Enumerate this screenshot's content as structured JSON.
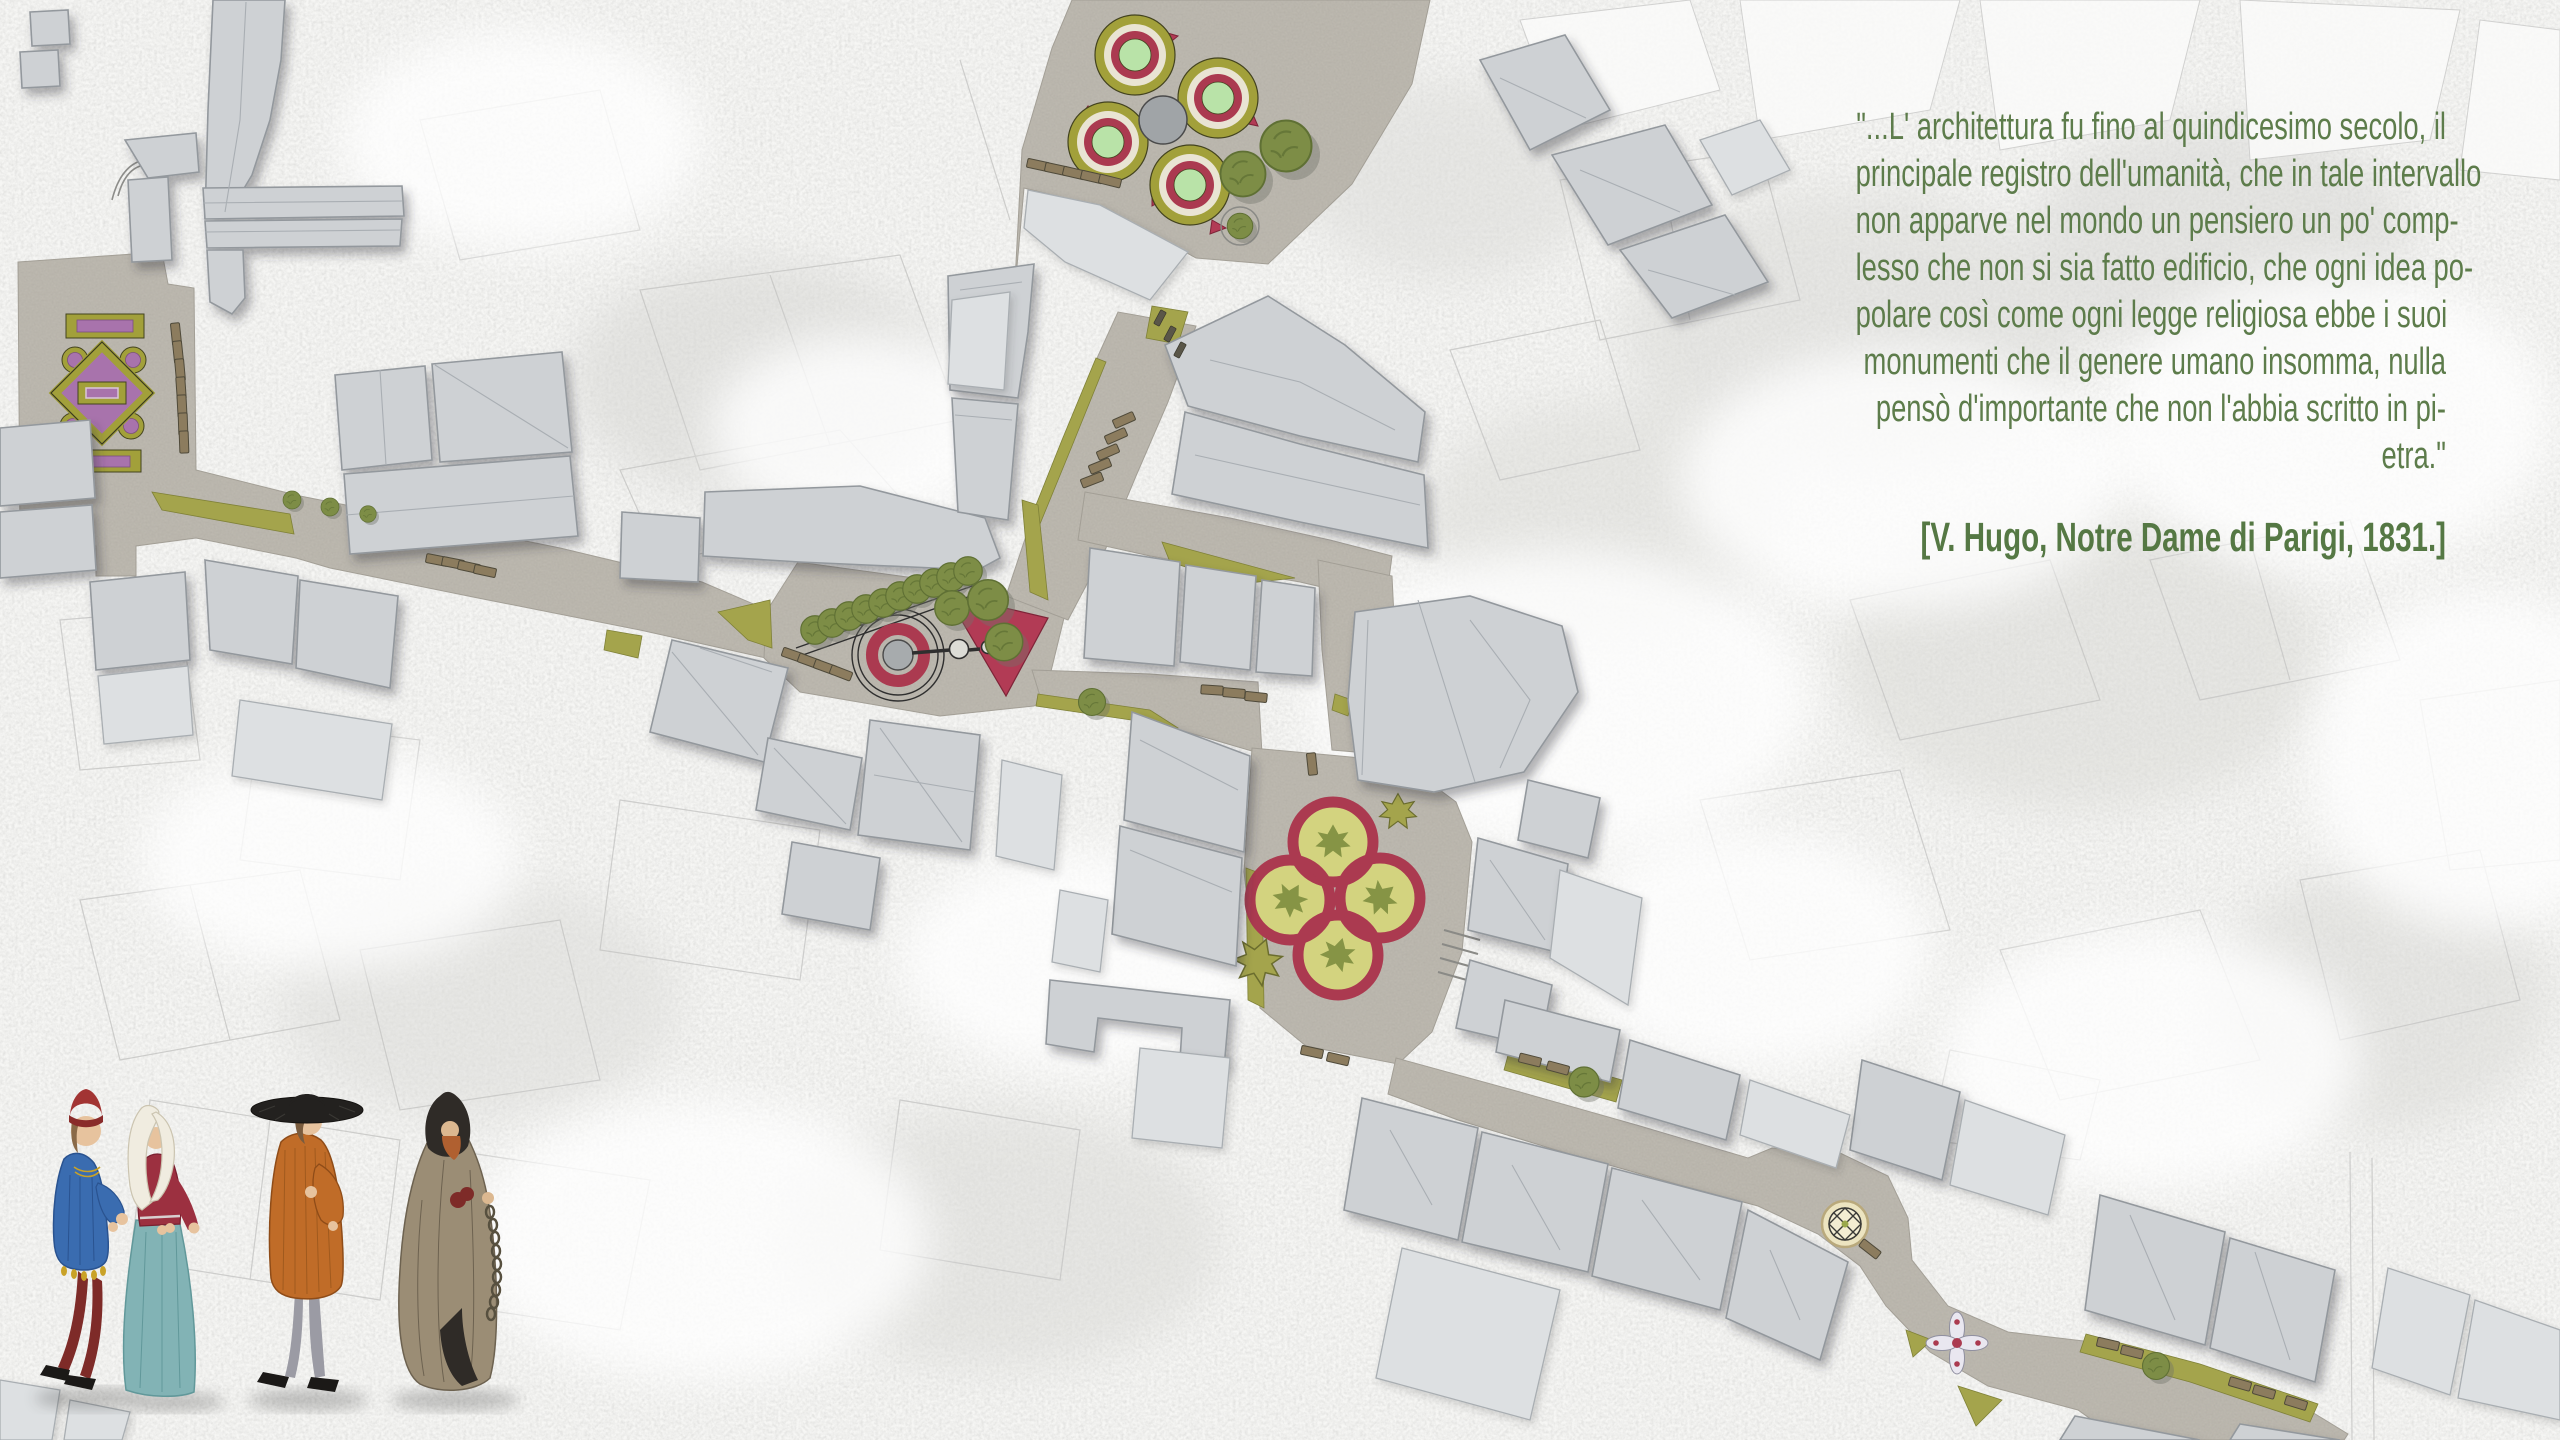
{
  "quote": {
    "lines": [
      "\"...L' architettura fu fino al quindicesimo secolo, il",
      "principale registro dell'umanità, che in tale intervallo",
      "non apparve nel mondo un pensiero un po' comp-",
      "lesso che non si sia fatto edificio, che ogni idea po-",
      "polare così come ogni legge religiosa ebbe i suoi",
      "monumenti che il genere umano insomma, nulla",
      "pensò d'importante che non l'abbia scritto in pi-",
      "etra.\""
    ],
    "attribution": "[V. Hugo, Notre Dame di Parigi, 1831.]"
  },
  "palette": {
    "quote_green": "#5d7c4b",
    "background": "#f6f6f4",
    "building_fill": "#ced1d4",
    "building_stroke": "#93989d",
    "street_paving": "#bcb8af",
    "grass": "#a4a44c",
    "hedge_olive": "#a2a03a",
    "crimson_ring": "#ab3a50",
    "red_plaza": "#b23b55",
    "pale_green": "#b9e3a8",
    "cream": "#e9e4d3",
    "parterre_purple": "#a873ac",
    "bench_brown": "#8c7c5e",
    "tree_green": "#7d8d46"
  },
  "map": {
    "features": [
      "left-formal-parterre-garden",
      "quadrilobe-circle-garden-plaza",
      "tree-lined-triangle-grove",
      "circular-fountain",
      "red-triangle-plaza",
      "four-ring-knot-garden",
      "paving-medallion",
      "floral-knot-paving",
      "street-benches",
      "street-trees",
      "grass-verges"
    ]
  },
  "figures": [
    "nobleman-in-blue-tunic",
    "lady-in-red-and-teal-gown",
    "burgher-in-orange-gown-black-hat",
    "monk-in-brown-cloak-with-chain"
  ]
}
